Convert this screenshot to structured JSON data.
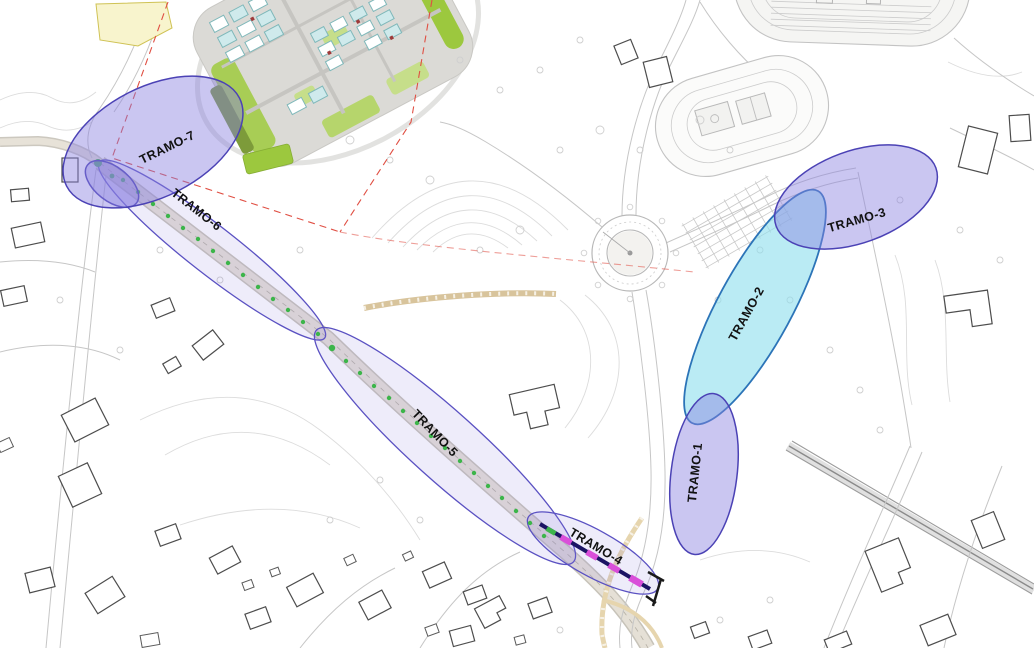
{
  "segments": [
    {
      "id": "tramo-1",
      "label": "TRAMO-1"
    },
    {
      "id": "tramo-2",
      "label": "TRAMO-2"
    },
    {
      "id": "tramo-3",
      "label": "TRAMO-3"
    },
    {
      "id": "tramo-4",
      "label": "TRAMO-4"
    },
    {
      "id": "tramo-5",
      "label": "TRAMO-5"
    },
    {
      "id": "tramo-6",
      "label": "TRAMO-6"
    },
    {
      "id": "tramo-7",
      "label": "TRAMO-7"
    }
  ],
  "colors": {
    "segment_fill_purple": "#8a80e0",
    "segment_stroke_purple": "#4b42b5",
    "corridor_stroke": "#5a51c2",
    "segment_fill_cyan": "#8fdfee",
    "segment_stroke_cyan": "#2c74b8",
    "boundary_red": "#e04f43",
    "tree_green": "#3cb54a",
    "works_magenta": "#d94fd9",
    "works_line_navy": "#1b1464",
    "campus_green": "#9cc83e",
    "label_color": "#111111"
  }
}
